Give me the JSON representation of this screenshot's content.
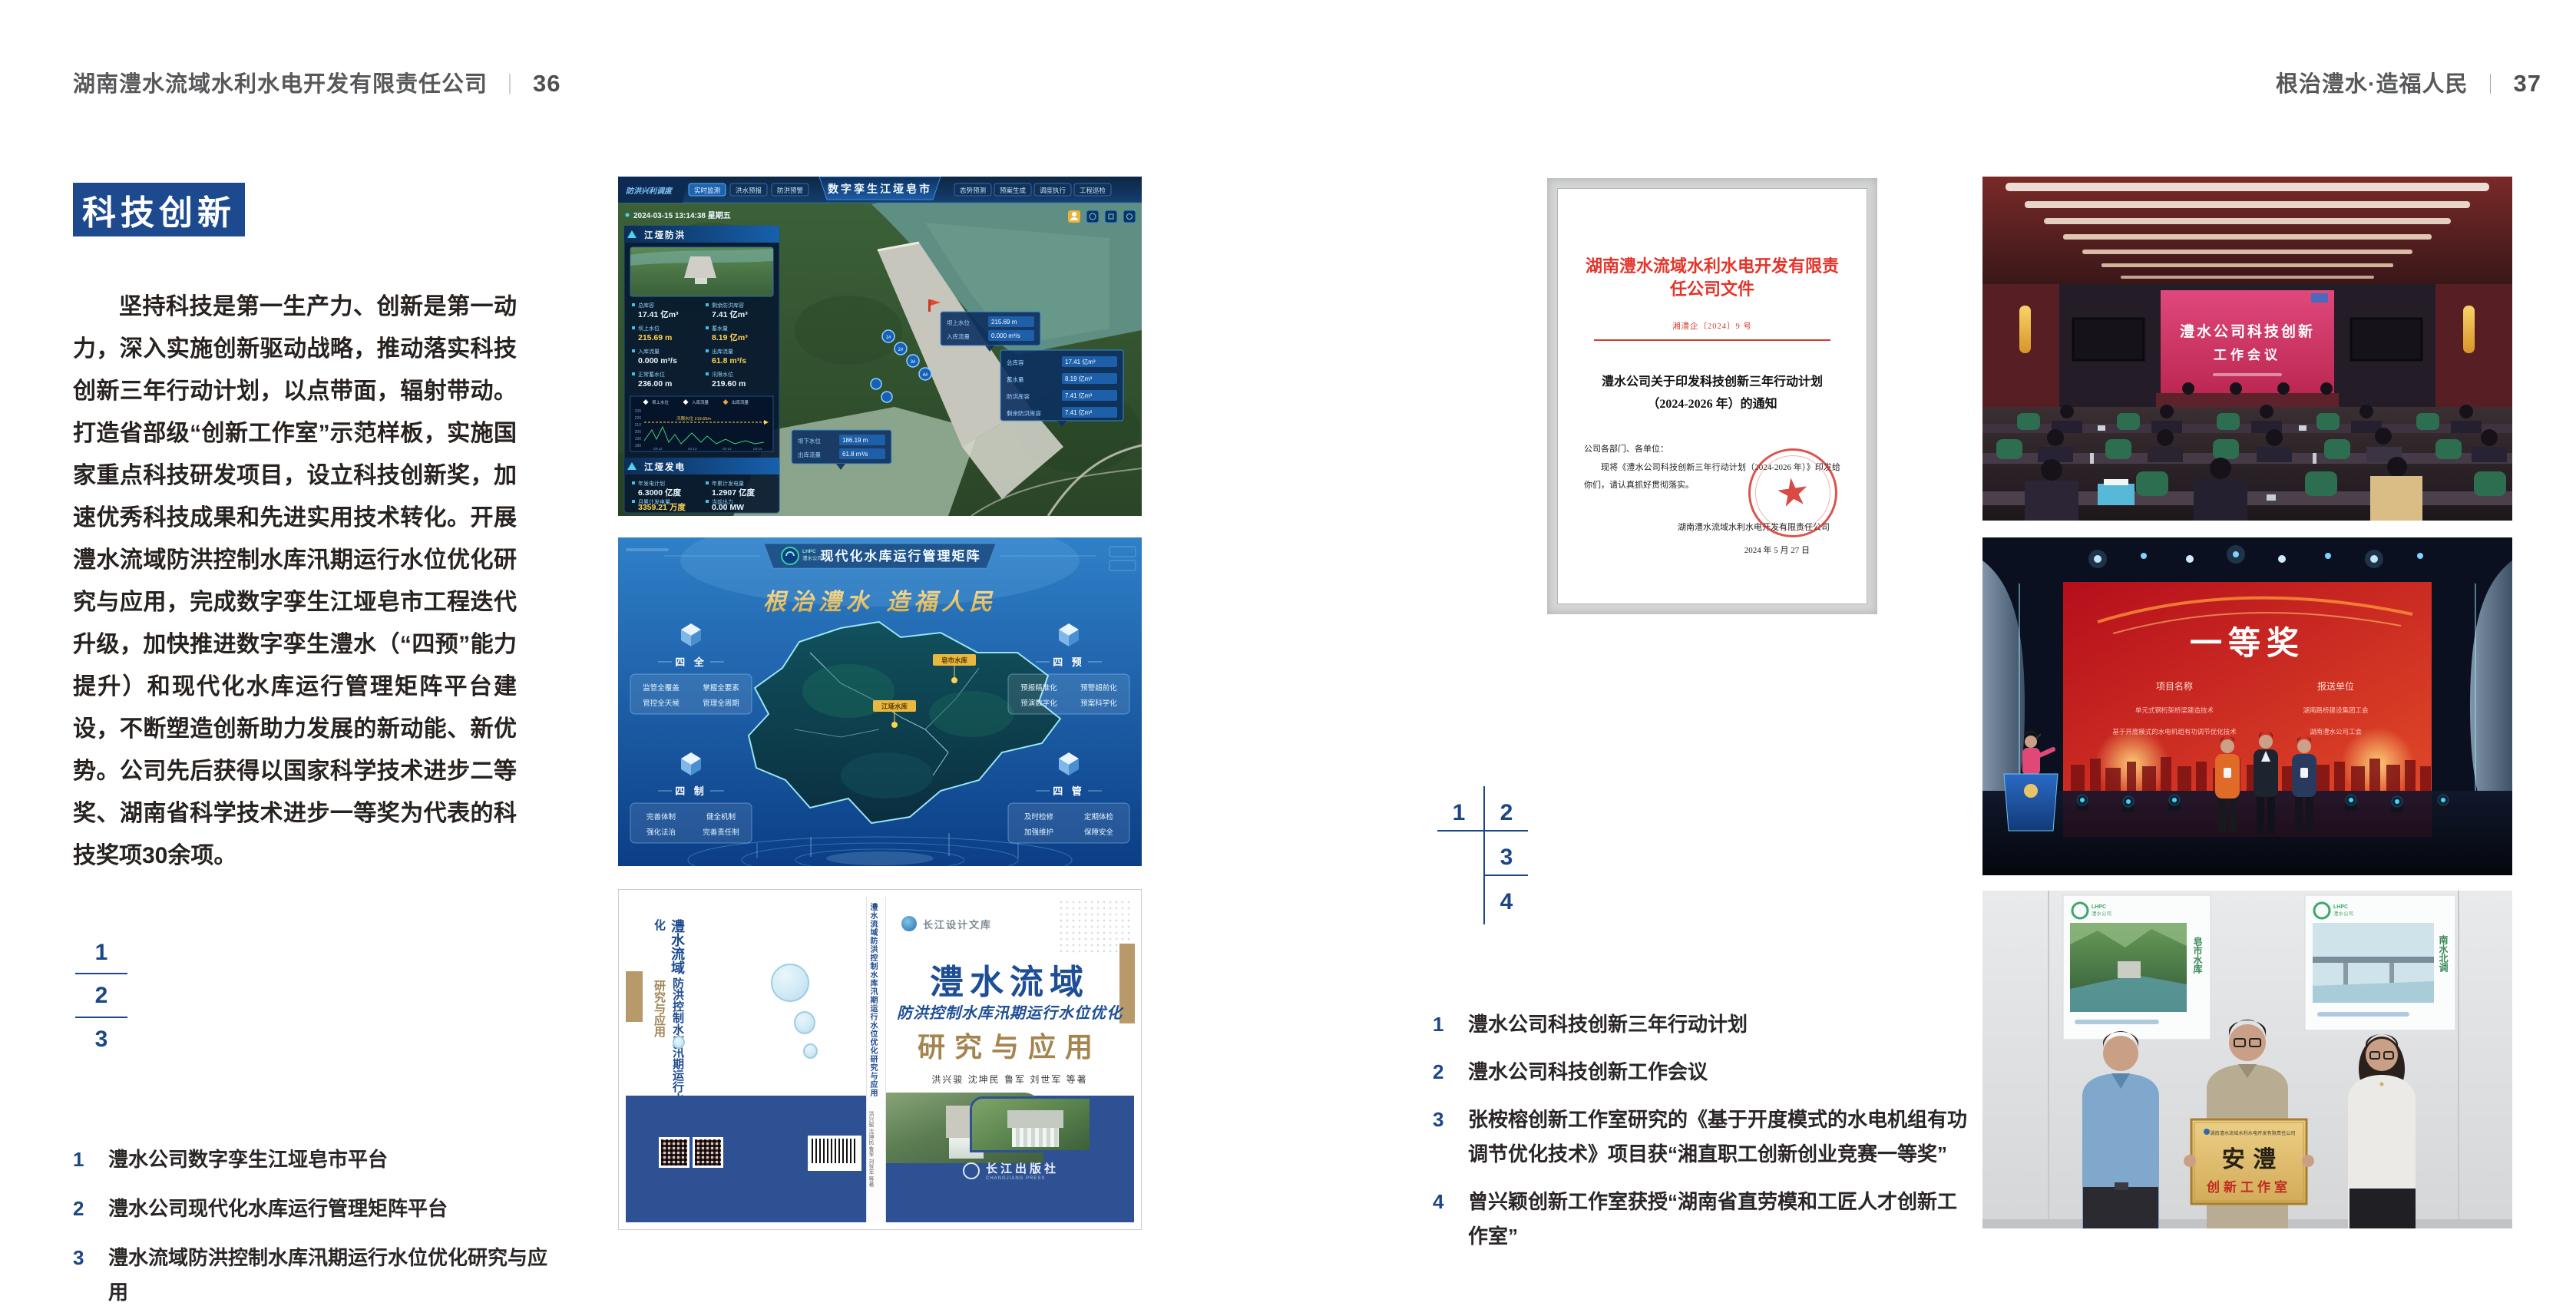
{
  "page_left": {
    "header": {
      "title": "湖南澧水流域水利水电开发有限责任公司",
      "sep": "｜",
      "page_number": "36"
    },
    "section_badge": "科技创新",
    "body_paragraph": "坚持科技是第一生产力、创新是第一动力，深入实施创新驱动战略，推动落实科技创新三年行动计划，以点带面，辐射带动。打造省部级“创新工作室”示范样板，实施国家重点科技研发项目，设立科技创新奖，加速优秀科技成果和先进实用技术转化。开展澧水流域防洪控制水库汛期运行水位优化研究与应用，完成数字孪生江垭皂市工程迭代升级，加快推进数字孪生澧水（“四预”能力提升）和现代化水库运行管理矩阵平台建设，不断塑造创新助力发展的新动能、新优势。公司先后获得以国家科学技术进步二等奖、湖南省科学技术进步一等奖为代表的科技奖项30余项。",
    "figure_index": [
      "1",
      "2",
      "3"
    ],
    "captions": [
      {
        "n": "1",
        "t": "澧水公司数字孪生江垭皂市平台"
      },
      {
        "n": "2",
        "t": "澧水公司现代化水库运行管理矩阵平台"
      },
      {
        "n": "3",
        "t": "澧水流域防洪控制水库汛期运行水位优化研究与应用"
      }
    ]
  },
  "page_right": {
    "header": {
      "title": "根治澧水·造福人民",
      "sep": "｜",
      "page_number": "37"
    },
    "figure_index": [
      "1",
      "2",
      "3",
      "4"
    ],
    "captions": [
      {
        "n": "1",
        "t": "澧水公司科技创新三年行动计划"
      },
      {
        "n": "2",
        "t": "澧水公司科技创新工作会议"
      },
      {
        "n": "3",
        "t": "张桉榕创新工作室研究的《基于开度模式的水电机组有功调节优化技术》项目获“湘直职工创新创业竞赛一等奖”"
      },
      {
        "n": "4",
        "t": "曾兴颖创新工作室获授“湖南省直劳模和工匠人才创新工作室”"
      }
    ]
  },
  "dashboard": {
    "title": "数字孪生江垭皂市",
    "module_label": "防洪兴利调度",
    "tabs_left": [
      "实时监测",
      "洪水预报",
      "防洪预警"
    ],
    "tabs_right": [
      "态势预测",
      "预案生成",
      "调度执行",
      "工程巡检"
    ],
    "datetime": "2024-03-15 13:14:38 星期五",
    "panel1": {
      "title": "江垭防洪",
      "stats": [
        {
          "l": "总库容",
          "v": "17.41 亿m³"
        },
        {
          "l": "剩余防洪库容",
          "v": "7.41 亿m³"
        },
        {
          "l": "坝上水位",
          "v": "215.69 m"
        },
        {
          "l": "蓄水量",
          "v": "8.19 亿m³"
        },
        {
          "l": "入库流量",
          "v": "0.000 m³/s"
        },
        {
          "l": "出库流量",
          "v": "61.8 m³/s"
        },
        {
          "l": "正常蓄水位",
          "v": "236.00 m"
        },
        {
          "l": "汛限水位",
          "v": "219.60 m"
        }
      ],
      "legend": [
        "坝上水位",
        "入库流量",
        "出库流量"
      ],
      "chart_annotation": "汛限水位 219.60m",
      "y_ticks": [
        "230",
        "220",
        "210",
        "200",
        "190",
        "180"
      ],
      "x_ticks": [
        "03-12",
        "03-13",
        "03-13",
        "03-14"
      ]
    },
    "panel2": {
      "title": "江垭发电",
      "stats": [
        {
          "l": "年发电计划",
          "v": "6.3000 亿度"
        },
        {
          "l": "年累计发电量",
          "v": "1.2907 亿度"
        },
        {
          "l": "月累计发电量",
          "v": "3359.21 万度"
        },
        {
          "l": "当前出力",
          "v": "0.00 MW"
        }
      ]
    },
    "tooltip1": {
      "rows": [
        [
          "坝上水位",
          "215.69 m"
        ],
        [
          "入库流量",
          "0.000 m³/s"
        ]
      ]
    },
    "tooltip2": {
      "rows": [
        [
          "总库容",
          "17.41 亿m³"
        ],
        [
          "蓄水量",
          "8.19 亿m³"
        ],
        [
          "防洪库容",
          "7.41 亿m³"
        ],
        [
          "剩余防洪库容",
          "7.41 亿m³"
        ]
      ]
    },
    "tooltip3": {
      "rows": [
        [
          "坝下水位",
          "186.19 m"
        ],
        [
          "出库流量",
          "61.8 m³/s"
        ]
      ]
    },
    "unit_markers": [
      "1#",
      "2#",
      "3#",
      "4#"
    ]
  },
  "matrix": {
    "logo": "LHPC",
    "logo_sub": "澧水公司",
    "title": "现代化水库运行管理矩阵",
    "slogan": "根治澧水  造福人民",
    "labels": [
      "皂市水库",
      "江垭水库"
    ],
    "groups": [
      {
        "title": "四 全",
        "items": [
          "监管全覆盖",
          "掌握全要素",
          "管控全天候",
          "管理全周期"
        ]
      },
      {
        "title": "四 预",
        "items": [
          "预报精准化",
          "预警超前化",
          "预演数字化",
          "预案科学化"
        ]
      },
      {
        "title": "四 制",
        "items": [
          "完善体制",
          "健全机制",
          "强化法治",
          "完善责任制"
        ]
      },
      {
        "title": "四 管",
        "items": [
          "及时检修",
          "定期体检",
          "加强维护",
          "保障安全"
        ]
      }
    ]
  },
  "book": {
    "series": "长江设计文库",
    "title": "澧水流域",
    "subtitle": "防洪控制水库汛期运行水位优化",
    "subtitle2": "研究与应用",
    "authors": "洪兴骏  沈坤民  鲁军  刘世军  等著",
    "publisher": "长江出版社",
    "publisher_en": "CHANGJIANG PRESS",
    "spine_title": "澧水流域防洪控制水库汛期运行水位优化研究与应用",
    "spine_authors": "洪兴骏 沈坤民 鲁军 刘世军 等著",
    "back_title1": "澧水流域",
    "back_title2": "防洪控制水库汛期运行水位优化",
    "back_title3": "研究与应用"
  },
  "document": {
    "masthead": "湖南澧水流域水利水电开发有限责任公司文件",
    "doc_number": "湘澧企〔2024〕9 号",
    "title_line1": "澧水公司关于印发科技创新三年行动计划",
    "title_line2": "（2024-2026 年）的通知",
    "salutation": "公司各部门、各单位：",
    "body": "现将《澧水公司科技创新三年行动计划（2024-2026 年）》印发给你们，请认真抓好贯彻落实。",
    "signature": "湖南澧水流域水利水电开发有限责任公司",
    "date": "2024 年 5 月 27 日"
  },
  "meeting": {
    "screen_line1": "澧水公司科技创新",
    "screen_line2": "工作会议"
  },
  "award": {
    "prize": "一等奖",
    "col1_header": "项目名称",
    "col2_header": "报送单位",
    "rows": [
      [
        "单元式钢桁架桥梁建造技术",
        "湖南路桥建设集团工会"
      ],
      [
        "基于开度模式的水电机组有功调节优化技术",
        "湖南澧水公司工会"
      ]
    ]
  },
  "plaque": {
    "header": "湖南澧水流域水利水电开发有限责任公司",
    "main": "安  澧",
    "sub": "创新工作室",
    "poster_logo": "LHPC",
    "poster_logo_sub": "澧水公司",
    "poster_left_text": "皂市水库",
    "poster_right_text": "南水北调"
  },
  "colors": {
    "accent_blue": "#1d4a8f",
    "caption_blue": "#1b4687",
    "doc_red": "#e3342a",
    "gold": "#e0b84d",
    "screen_pink": "#d63a6a",
    "award_red": "#c81622",
    "matrix_blue": "#0b3e86"
  }
}
